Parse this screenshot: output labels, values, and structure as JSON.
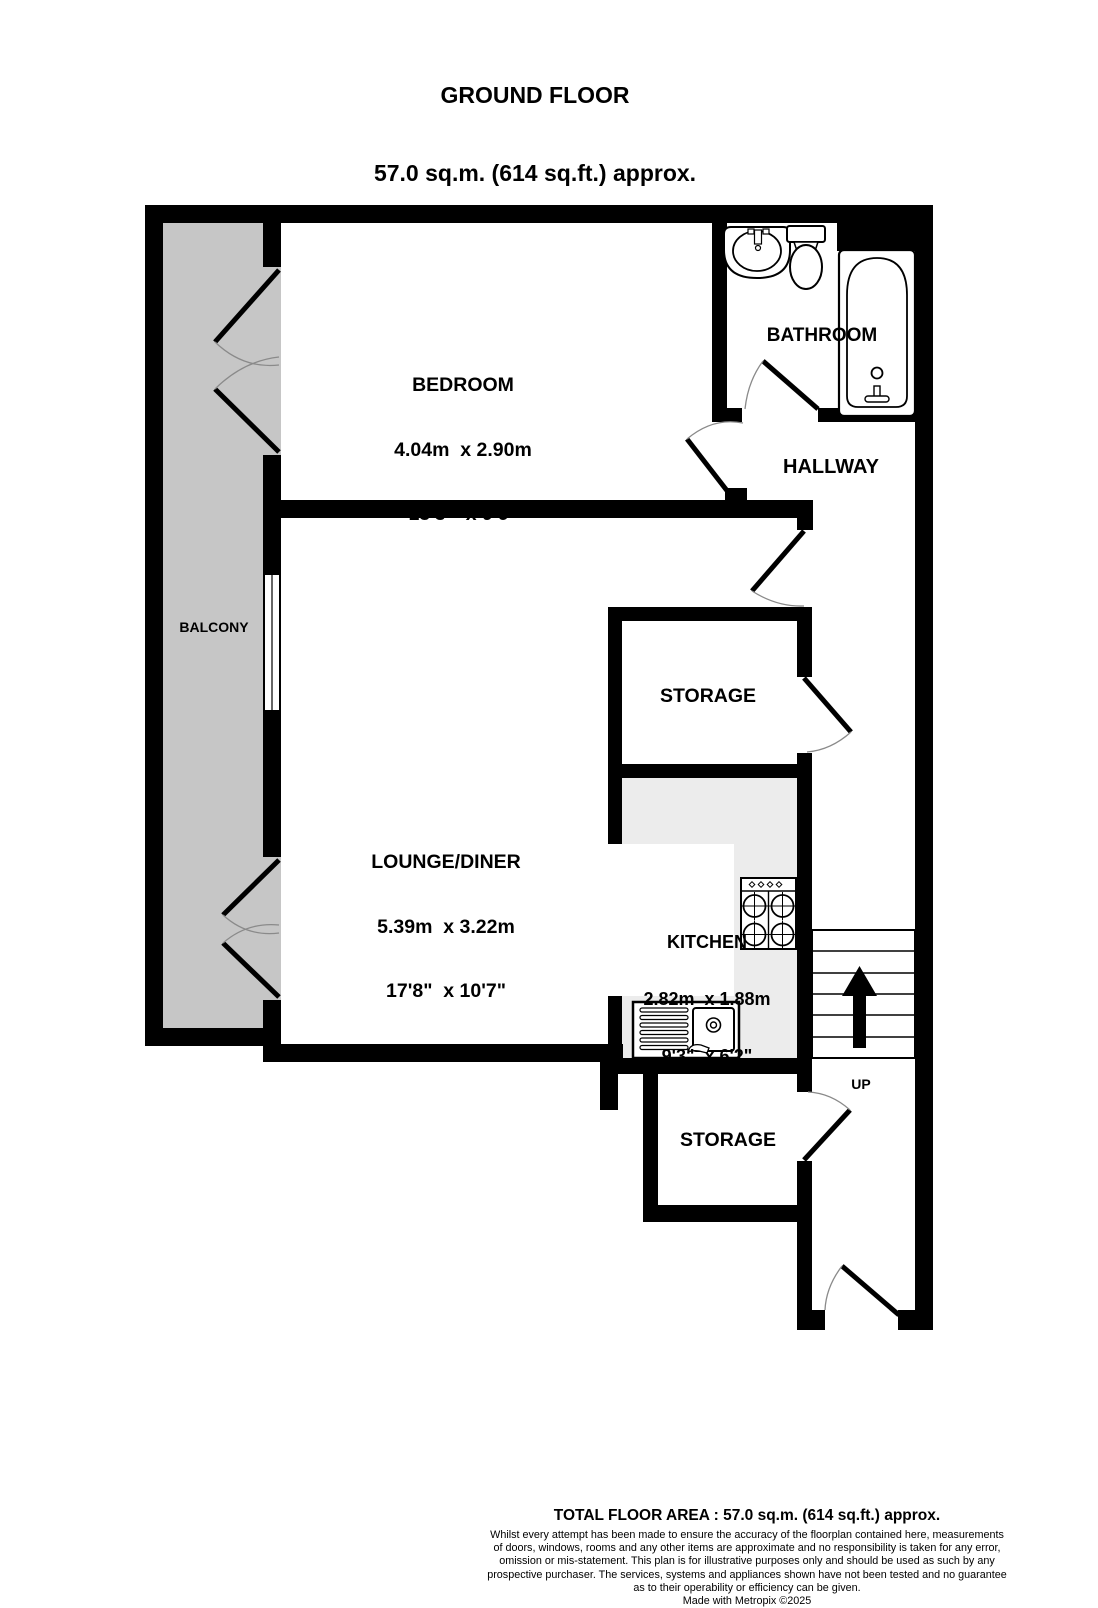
{
  "colors": {
    "wall": "#000000",
    "balcony": "#c6c6c6",
    "counter": "#ececec",
    "arc": "#8a8a8a"
  },
  "title": {
    "line1": "GROUND FLOOR",
    "line2": "57.0 sq.m. (614 sq.ft.) approx."
  },
  "rooms": {
    "bedroom": {
      "name": "BEDROOM",
      "size_metric": "4.04m  x 2.90m",
      "size_imperial": "13'3\"  x 9'6\""
    },
    "bathroom": {
      "name": "BATHROOM"
    },
    "hallway": {
      "name": "HALLWAY"
    },
    "balcony": {
      "name": "BALCONY"
    },
    "storage_upper": {
      "name": "STORAGE"
    },
    "lounge_diner": {
      "name": "LOUNGE/DINER",
      "size_metric": "5.39m  x 3.22m",
      "size_imperial": "17'8\"  x 10'7\""
    },
    "kitchen": {
      "name": "KITCHEN",
      "size_metric": "2.82m  x 1.88m",
      "size_imperial": "9'3\"  x 6'2\""
    },
    "storage_lower": {
      "name": "STORAGE"
    },
    "stairs": {
      "direction_label": "UP"
    }
  },
  "footer": {
    "total_area": "TOTAL FLOOR AREA : 57.0 sq.m. (614 sq.ft.) approx.",
    "disclaimer": "Whilst every attempt has been made to ensure the accuracy of the floorplan contained here, measurements of doors, windows, rooms and any other items are approximate and no responsibility is taken for any error, omission or mis-statement. This plan is for illustrative purposes only and should be used as such by any prospective purchaser. The services, systems and appliances shown have not been tested and no guarantee as to their operability or efficiency can be given.",
    "credit": "Made with Metropix ©2025"
  }
}
